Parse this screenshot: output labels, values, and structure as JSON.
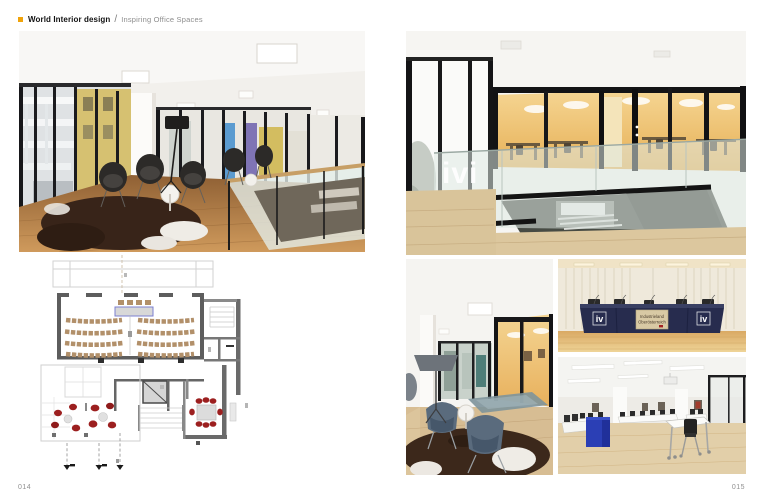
{
  "header": {
    "series_title": "World Interior design",
    "separator": "/",
    "page_subtitle": "Inspiring Office Spaces"
  },
  "footer": {
    "left_page_number": "014",
    "right_page_number": "015"
  },
  "photos": {
    "atrium": {
      "glass_etch_logo": "ivi"
    },
    "press_desk": {
      "logo_left": "iv",
      "logo_right": "iv",
      "banner_line1": "Industrieland",
      "banner_line2": "Oberösterreich"
    }
  },
  "colors": {
    "accent_orange": "#f0a30a",
    "subtitle_gray": "#8d8d8d",
    "desk_navy": "#272c4e",
    "lectern_blue": "#2b3fb5",
    "plan_seat_tan": "#b2906a",
    "plan_chair_red": "#9c1f1f"
  }
}
